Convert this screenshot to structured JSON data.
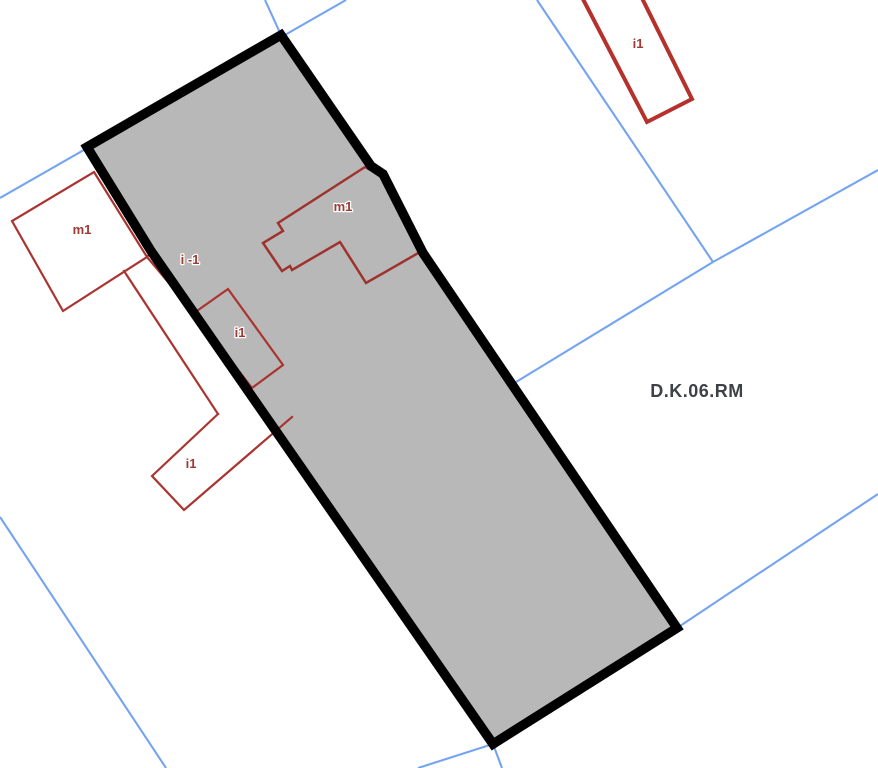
{
  "map": {
    "type": "cadastral-zoning-map",
    "canvas": {
      "width": 878,
      "height": 768,
      "background": "#ffffff"
    },
    "colors": {
      "parcel_fill": "#b8b8b8",
      "parcel_stroke": "#000000",
      "cadastral_line": "#74a4f0",
      "building_stroke": "#a93430",
      "building_label": "#9c3a33",
      "zone_label": "#3e4146"
    },
    "selected_parcel": {
      "stroke_width": 9.5,
      "points": [
        [
          87,
          147
        ],
        [
          281,
          35
        ],
        [
          371,
          166
        ],
        [
          383,
          174
        ],
        [
          423,
          253
        ],
        [
          677,
          628
        ],
        [
          493,
          744
        ],
        [
          151,
          251
        ]
      ]
    },
    "cadastral_lines": {
      "stroke_width": 2.1,
      "lines": [
        {
          "name": "boundary-line-top-left",
          "points": [
            [
              0,
              198
            ],
            [
              346,
              0
            ]
          ]
        },
        {
          "name": "boundary-line-top-corner",
          "points": [
            [
              265,
              0
            ],
            [
              281,
              35
            ]
          ]
        },
        {
          "name": "boundary-line-upper-right-a",
          "points": [
            [
              537,
              0
            ],
            [
              713,
              262
            ]
          ]
        },
        {
          "name": "boundary-line-upper-right-b",
          "points": [
            [
              713,
              262
            ],
            [
              878,
              170
            ]
          ]
        },
        {
          "name": "boundary-line-to-parcel",
          "points": [
            [
              713,
              262
            ],
            [
              516,
              382
            ]
          ]
        },
        {
          "name": "boundary-line-lower-right",
          "points": [
            [
              677,
              628
            ],
            [
              878,
              494
            ]
          ]
        },
        {
          "name": "boundary-line-lower-left",
          "points": [
            [
              0,
              517
            ],
            [
              166,
              768
            ]
          ]
        },
        {
          "name": "boundary-line-bottom-a",
          "points": [
            [
              418,
              768
            ],
            [
              493,
              744
            ]
          ]
        },
        {
          "name": "boundary-line-bottom-b",
          "points": [
            [
              493,
              744
            ],
            [
              502,
              768
            ]
          ]
        }
      ]
    },
    "buildings": [
      {
        "name": "building-m1-west",
        "closed": true,
        "stroke_width": 2.2,
        "color": "#a93430",
        "points": [
          [
            94,
            172
          ],
          [
            147,
            257
          ],
          [
            63,
            311
          ],
          [
            12,
            221
          ]
        ]
      },
      {
        "name": "building-west-stub",
        "closed": false,
        "stroke_width": 2.2,
        "color": "#a93430",
        "points": [
          [
            147,
            257
          ],
          [
            152,
            251
          ]
        ]
      },
      {
        "name": "building-west-link",
        "closed": false,
        "stroke_width": 2.2,
        "color": "#a93430",
        "points": [
          [
            147,
            257
          ],
          [
            194,
            313
          ]
        ]
      },
      {
        "name": "building-west-corridor",
        "closed": false,
        "stroke_width": 2.2,
        "color": "#a93430",
        "points": [
          [
            124,
            271
          ],
          [
            218,
            414
          ]
        ]
      },
      {
        "name": "building-i1-south",
        "closed": false,
        "stroke_width": 2.2,
        "color": "#a93430",
        "points": [
          [
            218,
            414
          ],
          [
            152,
            476
          ],
          [
            184,
            510
          ],
          [
            292,
            417
          ]
        ]
      },
      {
        "name": "building-i1-mid",
        "closed": true,
        "stroke_width": 2.2,
        "color": "#a93430",
        "points": [
          [
            228,
            289
          ],
          [
            194,
            313
          ],
          [
            252,
            388
          ],
          [
            283,
            365
          ]
        ]
      },
      {
        "name": "building-m1-central",
        "closed": true,
        "stroke_width": 2.5,
        "color": "#9e332e",
        "points": [
          [
            365,
            167
          ],
          [
            278,
            223
          ],
          [
            283,
            231
          ],
          [
            263,
            243
          ],
          [
            282,
            271
          ],
          [
            290,
            266
          ],
          [
            292,
            270
          ],
          [
            340,
            242
          ],
          [
            366,
            283
          ],
          [
            420,
            252
          ],
          [
            383,
            175
          ],
          [
            373,
            171
          ]
        ]
      },
      {
        "name": "building-i1-northeast",
        "closed": true,
        "stroke_width": 4,
        "color": "#b5312b",
        "points": [
          [
            573,
            -20
          ],
          [
            633,
            -20
          ],
          [
            692,
            99
          ],
          [
            647,
            122
          ]
        ]
      }
    ],
    "building_labels": [
      {
        "text": "m1",
        "x": 82,
        "y": 234,
        "font_size": 13
      },
      {
        "text": "i -1",
        "x": 190,
        "y": 264,
        "font_size": 13
      },
      {
        "text": "i1",
        "x": 240,
        "y": 337,
        "font_size": 13
      },
      {
        "text": "i1",
        "x": 191,
        "y": 468,
        "font_size": 13
      },
      {
        "text": "m1",
        "x": 343,
        "y": 211,
        "font_size": 13
      },
      {
        "text": "i1",
        "x": 638,
        "y": 48,
        "font_size": 13
      }
    ],
    "zone_label": {
      "text": "D.K.06.RM",
      "x": 697,
      "y": 397,
      "font_size": 18
    }
  }
}
